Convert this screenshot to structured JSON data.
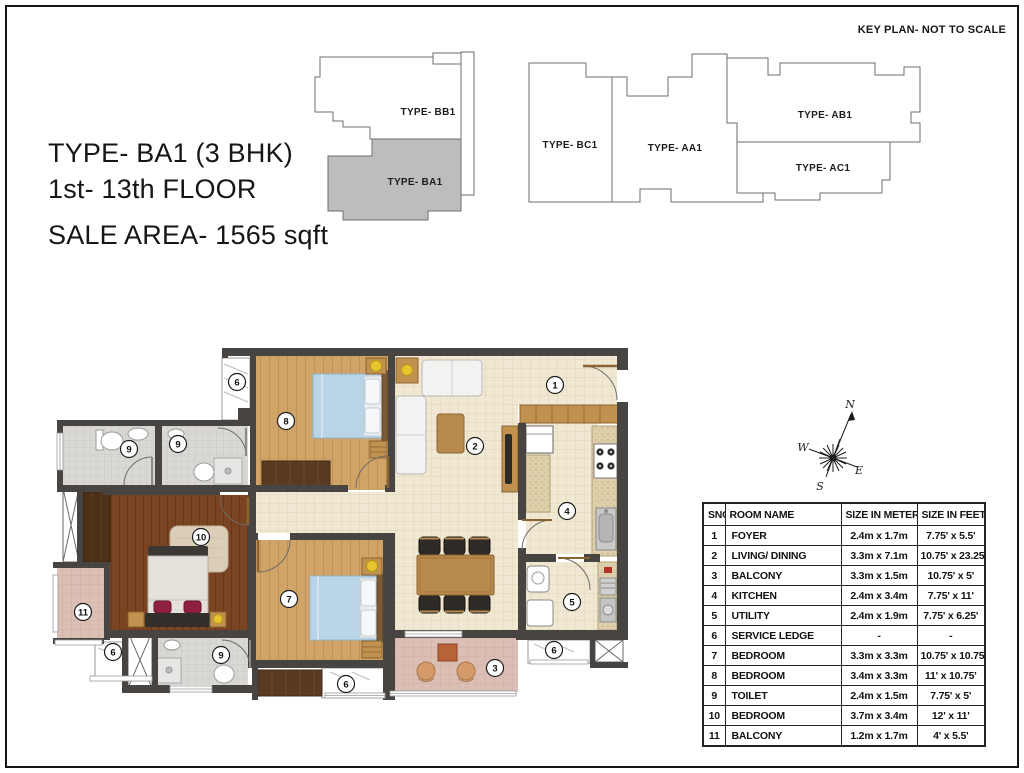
{
  "title_block": {
    "line1": "TYPE- BA1 (3 BHK)",
    "line2": "1st- 13th FLOOR",
    "line3": "SALE AREA- 1565 sqft"
  },
  "key_plan": {
    "heading": "KEY PLAN- NOT TO SCALE",
    "units": [
      {
        "label": "TYPE- BB1",
        "highlighted": false
      },
      {
        "label": "TYPE- BA1",
        "highlighted": true
      },
      {
        "label": "TYPE- BC1",
        "highlighted": false
      },
      {
        "label": "TYPE- AA1",
        "highlighted": false
      },
      {
        "label": "TYPE- AB1",
        "highlighted": false
      },
      {
        "label": "TYPE- AC1",
        "highlighted": false
      }
    ]
  },
  "compass": {
    "n": "N",
    "s": "S",
    "e": "E",
    "w": "W"
  },
  "floor_plan": {
    "markers": {
      "m1": "1",
      "m2": "2",
      "m3": "3",
      "m4": "4",
      "m5": "5",
      "m6a": "6",
      "m6b": "6",
      "m6c": "6",
      "m6d": "6",
      "m7": "7",
      "m8": "8",
      "m9a": "9",
      "m9b": "9",
      "m9c": "9",
      "m10": "10",
      "m11": "11"
    }
  },
  "table": {
    "headers": [
      "SNO",
      "ROOM NAME",
      "SIZE IN METERS",
      "SIZE IN FEET"
    ],
    "rows": [
      {
        "sno": "1",
        "room": "FOYER",
        "meters": "2.4m x 1.7m",
        "feet": "7.75' x 5.5'"
      },
      {
        "sno": "2",
        "room": "LIVING/ DINING",
        "meters": "3.3m x 7.1m",
        "feet": "10.75' x 23.25'"
      },
      {
        "sno": "3",
        "room": "BALCONY",
        "meters": "3.3m x 1.5m",
        "feet": "10.75' x 5'"
      },
      {
        "sno": "4",
        "room": "KITCHEN",
        "meters": "2.4m x 3.4m",
        "feet": "7.75' x 11'"
      },
      {
        "sno": "5",
        "room": "UTILITY",
        "meters": "2.4m x 1.9m",
        "feet": "7.75' x 6.25'"
      },
      {
        "sno": "6",
        "room": "SERVICE LEDGE",
        "meters": "-",
        "feet": "-"
      },
      {
        "sno": "7",
        "room": "BEDROOM",
        "meters": "3.3m x 3.3m",
        "feet": "10.75' x 10.75'"
      },
      {
        "sno": "8",
        "room": "BEDROOM",
        "meters": "3.4m x 3.3m",
        "feet": "11' x 10.75'"
      },
      {
        "sno": "9",
        "room": "TOILET",
        "meters": "2.4m x 1.5m",
        "feet": "7.75' x 5'"
      },
      {
        "sno": "10",
        "room": "BEDROOM",
        "meters": "3.7m x 3.4m",
        "feet": "12' x 11'"
      },
      {
        "sno": "11",
        "room": "BALCONY",
        "meters": "1.2m x 1.7m",
        "feet": "4' x 5.5'"
      }
    ]
  },
  "colors": {
    "wall": "#474441",
    "wood_light": "#d0a467",
    "wood_dark": "#7a4423",
    "wardrobe": "#5b3a22",
    "cream_floor": "#f0e8d2",
    "balcony_pink": "#dcbfb4",
    "toilet_tile": "#d9d8d5",
    "bed_blue": "#b9d4e6",
    "accent_yellow": "#e6c52e",
    "pillow_red": "#8e2040",
    "keyplan_highlight": "#bdbdbd"
  }
}
